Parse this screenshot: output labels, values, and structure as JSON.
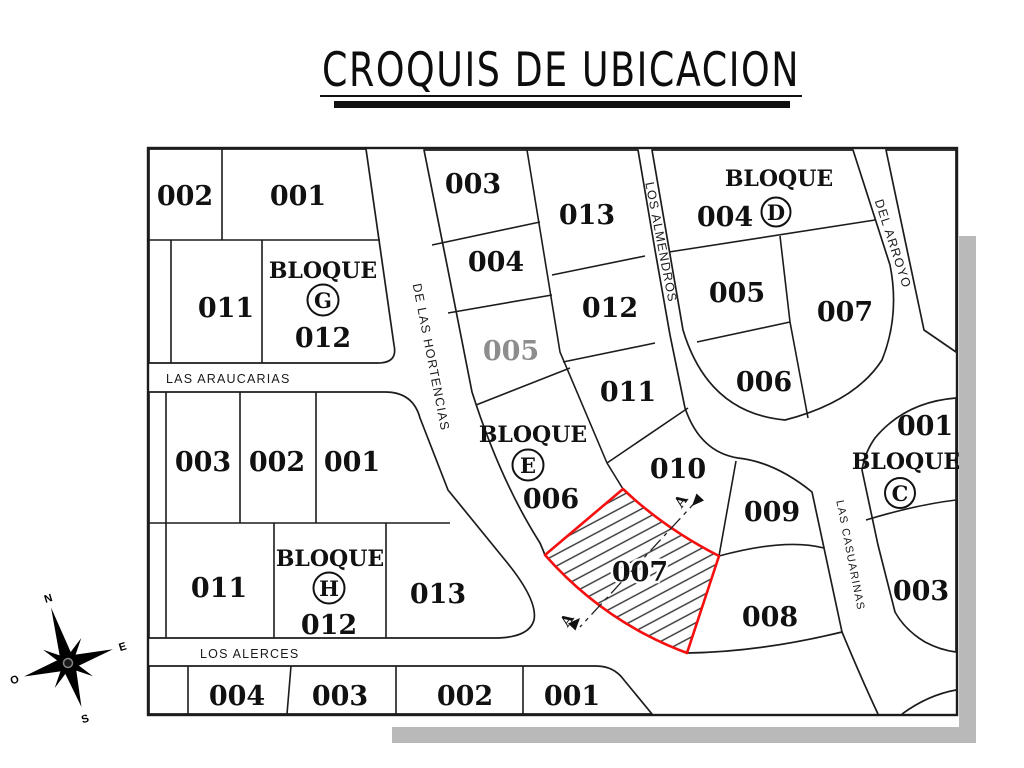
{
  "title": "CROQUIS DE UBICACION",
  "streets": {
    "araucarias": "LAS ARAUCARIAS",
    "alerces": "LOS ALERCES",
    "hortencias": "DE LAS HORTENCIAS",
    "almendros": "LOS ALMENDROS",
    "arroyo": "DEL ARROYO",
    "casuarinas": "LAS CASUARINAS"
  },
  "blocks": {
    "g": {
      "title": "BLOQUE",
      "letter": "G",
      "lots": {
        "l002": "002",
        "l001": "001",
        "l011": "011",
        "l012": "012"
      }
    },
    "h": {
      "title": "BLOQUE",
      "letter": "H",
      "lots": {
        "l003": "003",
        "l002": "002",
        "l001": "001",
        "l011": "011",
        "l012": "012",
        "l013": "013"
      }
    },
    "south": {
      "lots": {
        "l004": "004",
        "l003": "003",
        "l002": "002",
        "l001": "001"
      }
    },
    "e": {
      "title": "BLOQUE",
      "letter": "E",
      "lots": {
        "l003": "003",
        "l013": "013",
        "l004": "004",
        "l012": "012",
        "l005": "005",
        "l011": "011",
        "l006": "006",
        "l007": "007",
        "l010": "010",
        "l009": "009",
        "l008": "008"
      }
    },
    "d": {
      "title": "BLOQUE",
      "letter": "D",
      "lots": {
        "l004": "004",
        "l005": "005",
        "l007": "007",
        "l006": "006"
      }
    },
    "c": {
      "title": "BLOQUE",
      "letter": "C",
      "lots": {
        "l001": "001",
        "l003": "003"
      }
    }
  },
  "highlight": {
    "lot": "007",
    "color": "#f50f0f",
    "section_marker": "A"
  },
  "compass": {
    "n": "N",
    "e": "E",
    "s": "S",
    "o": "O"
  }
}
